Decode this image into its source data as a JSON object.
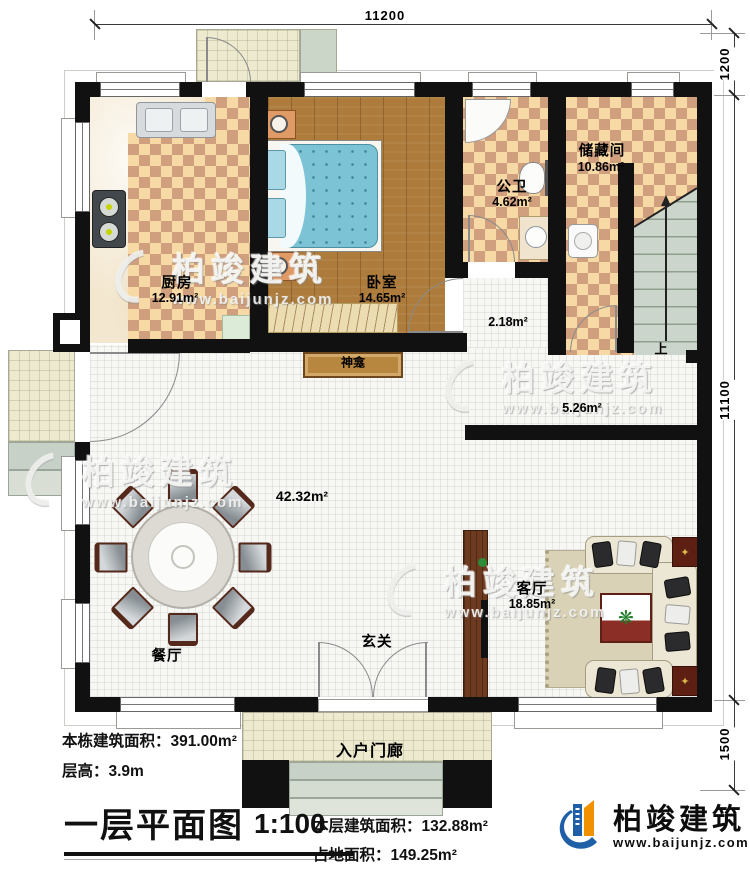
{
  "dimensions": {
    "top": "11200",
    "right_top": "1200",
    "right_mid": "11100",
    "right_bottom": "1500"
  },
  "rooms": {
    "kitchen": {
      "name": "厨房",
      "area": "12.91m²"
    },
    "bedroom": {
      "name": "卧室",
      "area": "14.65m²"
    },
    "bathroom": {
      "name": "公卫",
      "area": "4.62m²"
    },
    "storage": {
      "name": "储藏间",
      "area": "10.86m²"
    },
    "hall": {
      "area": "2.18m²"
    },
    "corridor": {
      "area": "5.26m²"
    },
    "open_area": {
      "area": "42.32m²"
    },
    "dining": {
      "name": "餐厅"
    },
    "foyer": {
      "name": "玄关"
    },
    "living": {
      "name": "客厅",
      "area": "18.85m²"
    },
    "entrance_porch": {
      "name": "入户门廊"
    },
    "shrine": {
      "name": "神龛"
    },
    "stairs": {
      "direction_label": "上"
    }
  },
  "title_block": {
    "building_total_area": "本栋建筑面积：391.00m²",
    "floor_height": "层高：3.9m",
    "plan_title": "一层平面图",
    "scale": "1:100",
    "floor_area": "本层建筑面积：132.88m²",
    "footprint_area": "占地面积：149.25m²"
  },
  "brand": {
    "name": "柏竣建筑",
    "website": "www.baijunjz.com"
  },
  "watermark": {
    "name": "柏竣建筑",
    "website": "www.baijunjz.com"
  },
  "colors": {
    "wall": "#111111",
    "tile_light": "#f6d9a4",
    "tile_dark": "#cf9f7e",
    "wood_floor": "#ad7c3c",
    "accent_blue": "#1f5fa8",
    "accent_orange": "#f29100"
  }
}
